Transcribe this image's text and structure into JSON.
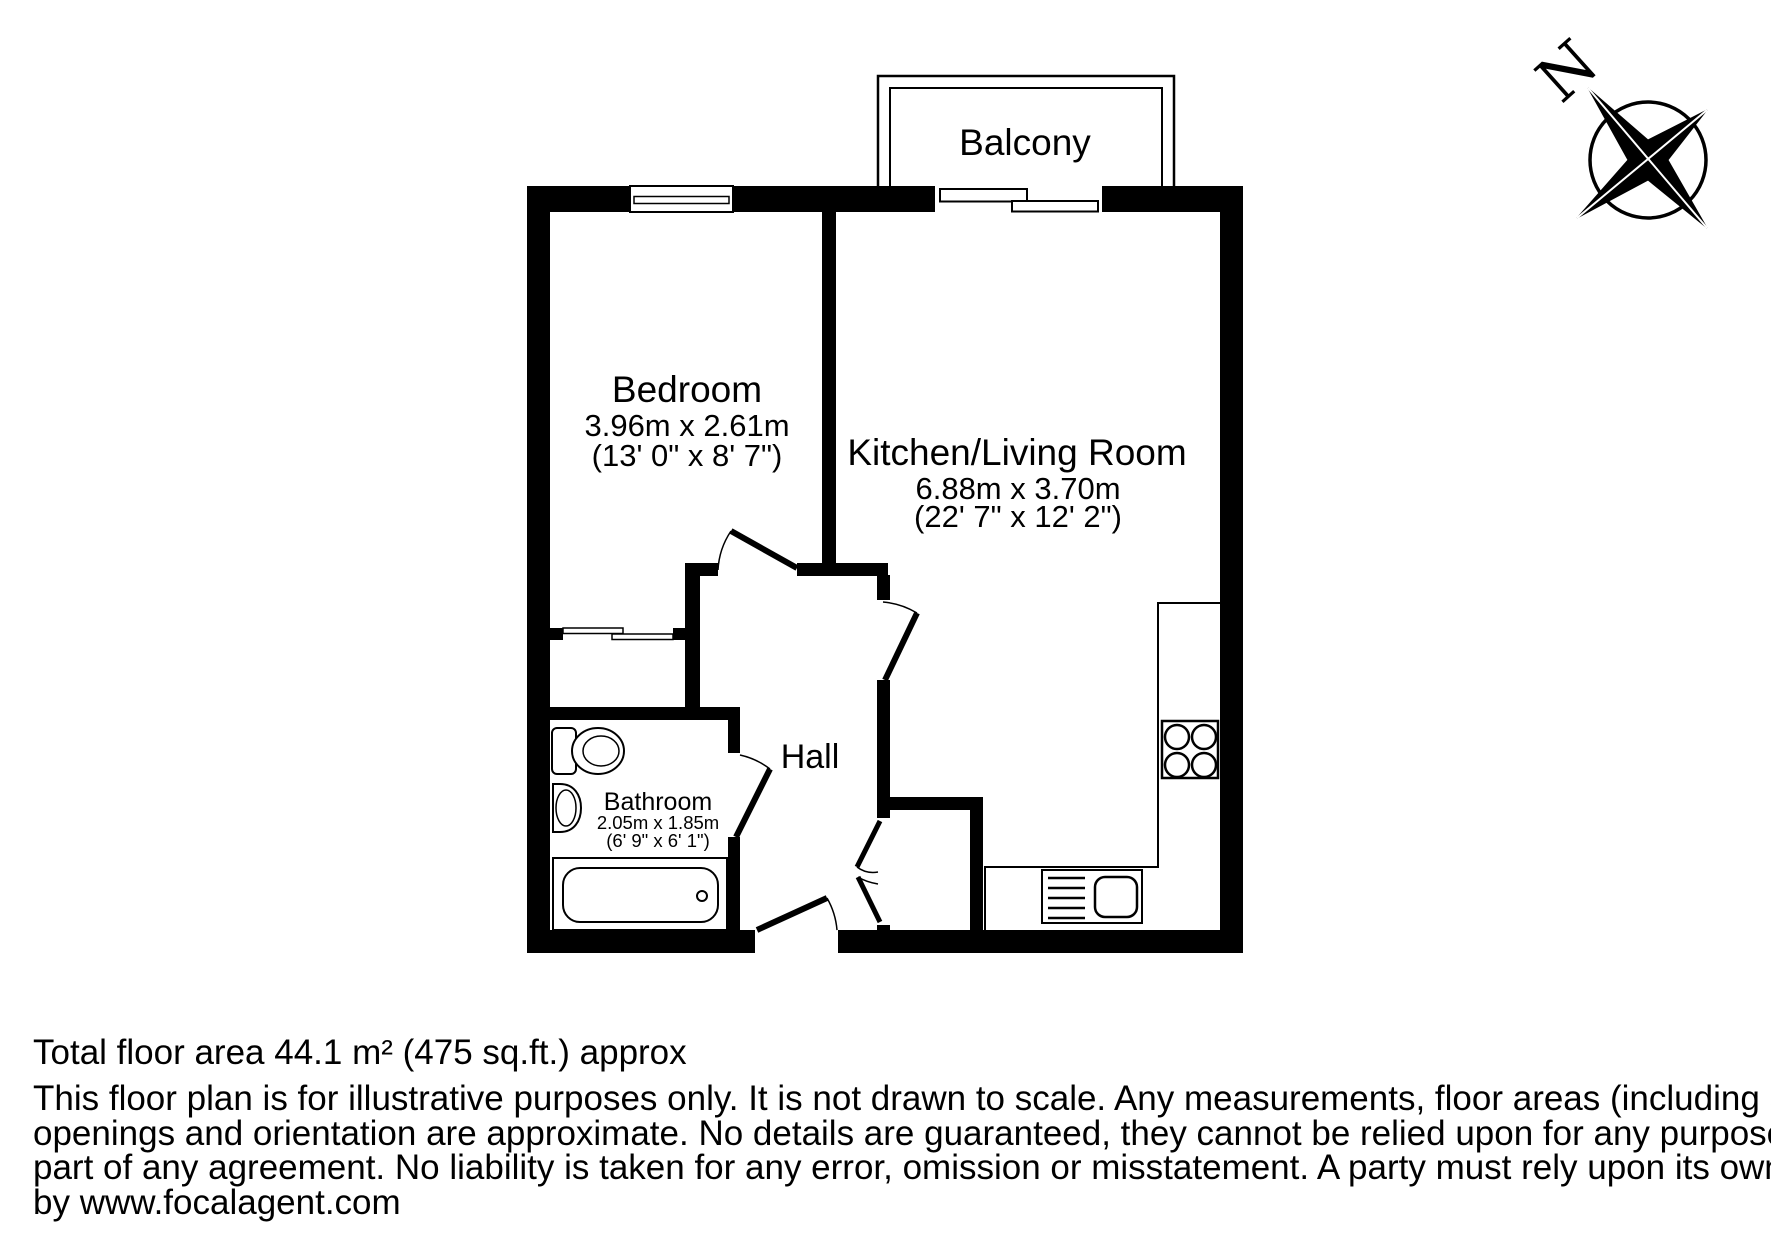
{
  "plan": {
    "rooms": {
      "balcony": {
        "label": "Balcony"
      },
      "bedroom": {
        "label": "Bedroom",
        "dims_metric": "3.96m x 2.61m",
        "dims_imperial": "(13' 0\" x 8' 7\")"
      },
      "kitchen_living": {
        "label": "Kitchen/Living Room",
        "dims_metric": "6.88m x 3.70m",
        "dims_imperial": "(22' 7\" x 12' 2\")"
      },
      "bathroom": {
        "label": "Bathroom",
        "dims_metric": "2.05m x 1.85m",
        "dims_imperial": "(6' 9\" x 6' 1\")"
      },
      "hall": {
        "label": "Hall"
      }
    },
    "compass": {
      "north_label": "N"
    }
  },
  "footer": {
    "total_area": "Total floor area 44.1 m² (475 sq.ft.) approx",
    "disclaimer_lines": [
      "This floor plan is for illustrative purposes only. It is not drawn to scale. Any measurements, floor areas (including any total floor area),",
      "openings and orientation are approximate. No details are guaranteed, they cannot be relied upon for any purpose and they do not form",
      "part of any agreement. No liability is taken for any error, omission or misstatement. A party must rely upon its own inspection(s). Powered",
      "by www.focalagent.com"
    ]
  },
  "colors": {
    "ink": "#000000",
    "paper": "#ffffff"
  }
}
